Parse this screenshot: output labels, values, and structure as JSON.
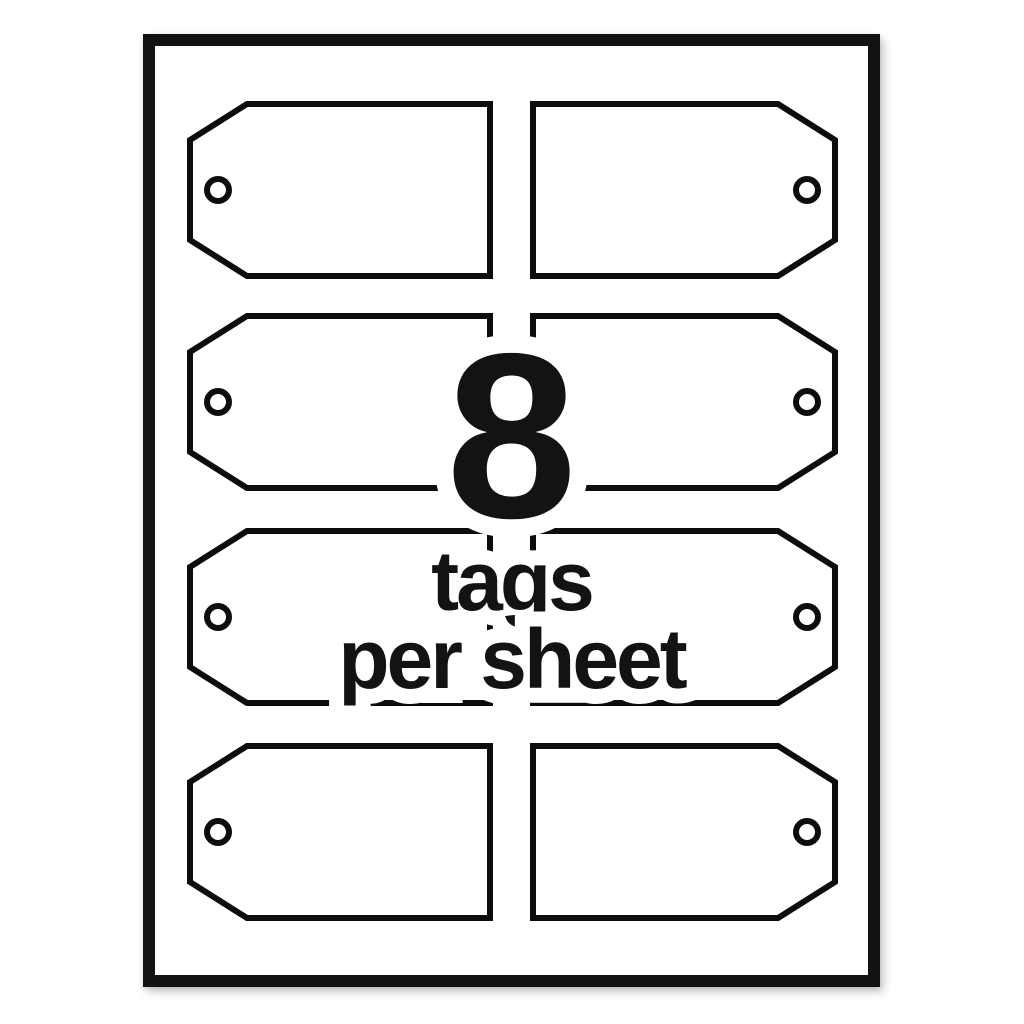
{
  "product_preview": {
    "overlay": {
      "count": "8",
      "unit": "tags",
      "per": "per sheet"
    },
    "grid": {
      "rows": 4,
      "columns": 2,
      "total_tags": 8
    },
    "colors": {
      "page_background": "#ffffff",
      "sheet_fill": "#ffffff",
      "sheet_border": "#121212",
      "tag_outline": "#0d0d0d",
      "overlay_text": "#131313",
      "halo": "#ffffff"
    }
  }
}
